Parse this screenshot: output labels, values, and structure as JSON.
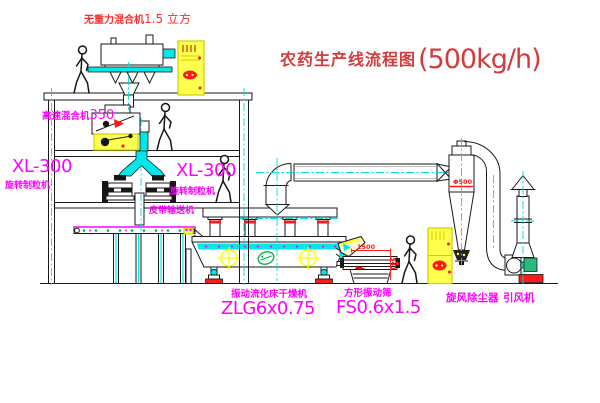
{
  "title": {
    "name": "农药生产线流程图",
    "capacity": "(500kg/h)"
  },
  "equipment": {
    "gravity_mixer": {
      "label": "无重力混合机",
      "spec": "1.5 立方"
    },
    "high_speed_mixer": {
      "label": "高速混合机",
      "model": "350"
    },
    "granulator_left": {
      "model": "XL-300",
      "label": "旋转制粒机"
    },
    "granulator_right": {
      "model": "XL-300",
      "label": "旋转制粒机"
    },
    "belt_conveyor": {
      "label": "皮带输送机"
    },
    "fluid_bed_dryer": {
      "label": "振动流化床干燥机",
      "model": "ZLG6x0.75"
    },
    "vibrating_sieve": {
      "label": "方形振动筛",
      "model": "FS0.6x1.5"
    },
    "cyclone": {
      "label": "旋风除尘器"
    },
    "fan": {
      "label": "引风机"
    }
  },
  "dimensions": {
    "sieve_length": "1500",
    "sieve_height": "541",
    "cyclone_diameter": "Φ500"
  },
  "colors": {
    "line": "#1a1a1a",
    "centerline": "#00dcdc",
    "label_magenta": "#ff00ff",
    "title_red": "#d43b3b",
    "accent_red": "#ff1a1a",
    "cabinet_yellow": "#ffff4d",
    "machine_cyan": "#00e8e8",
    "motor_green": "#2db87d",
    "logo_green": "#00a550"
  }
}
